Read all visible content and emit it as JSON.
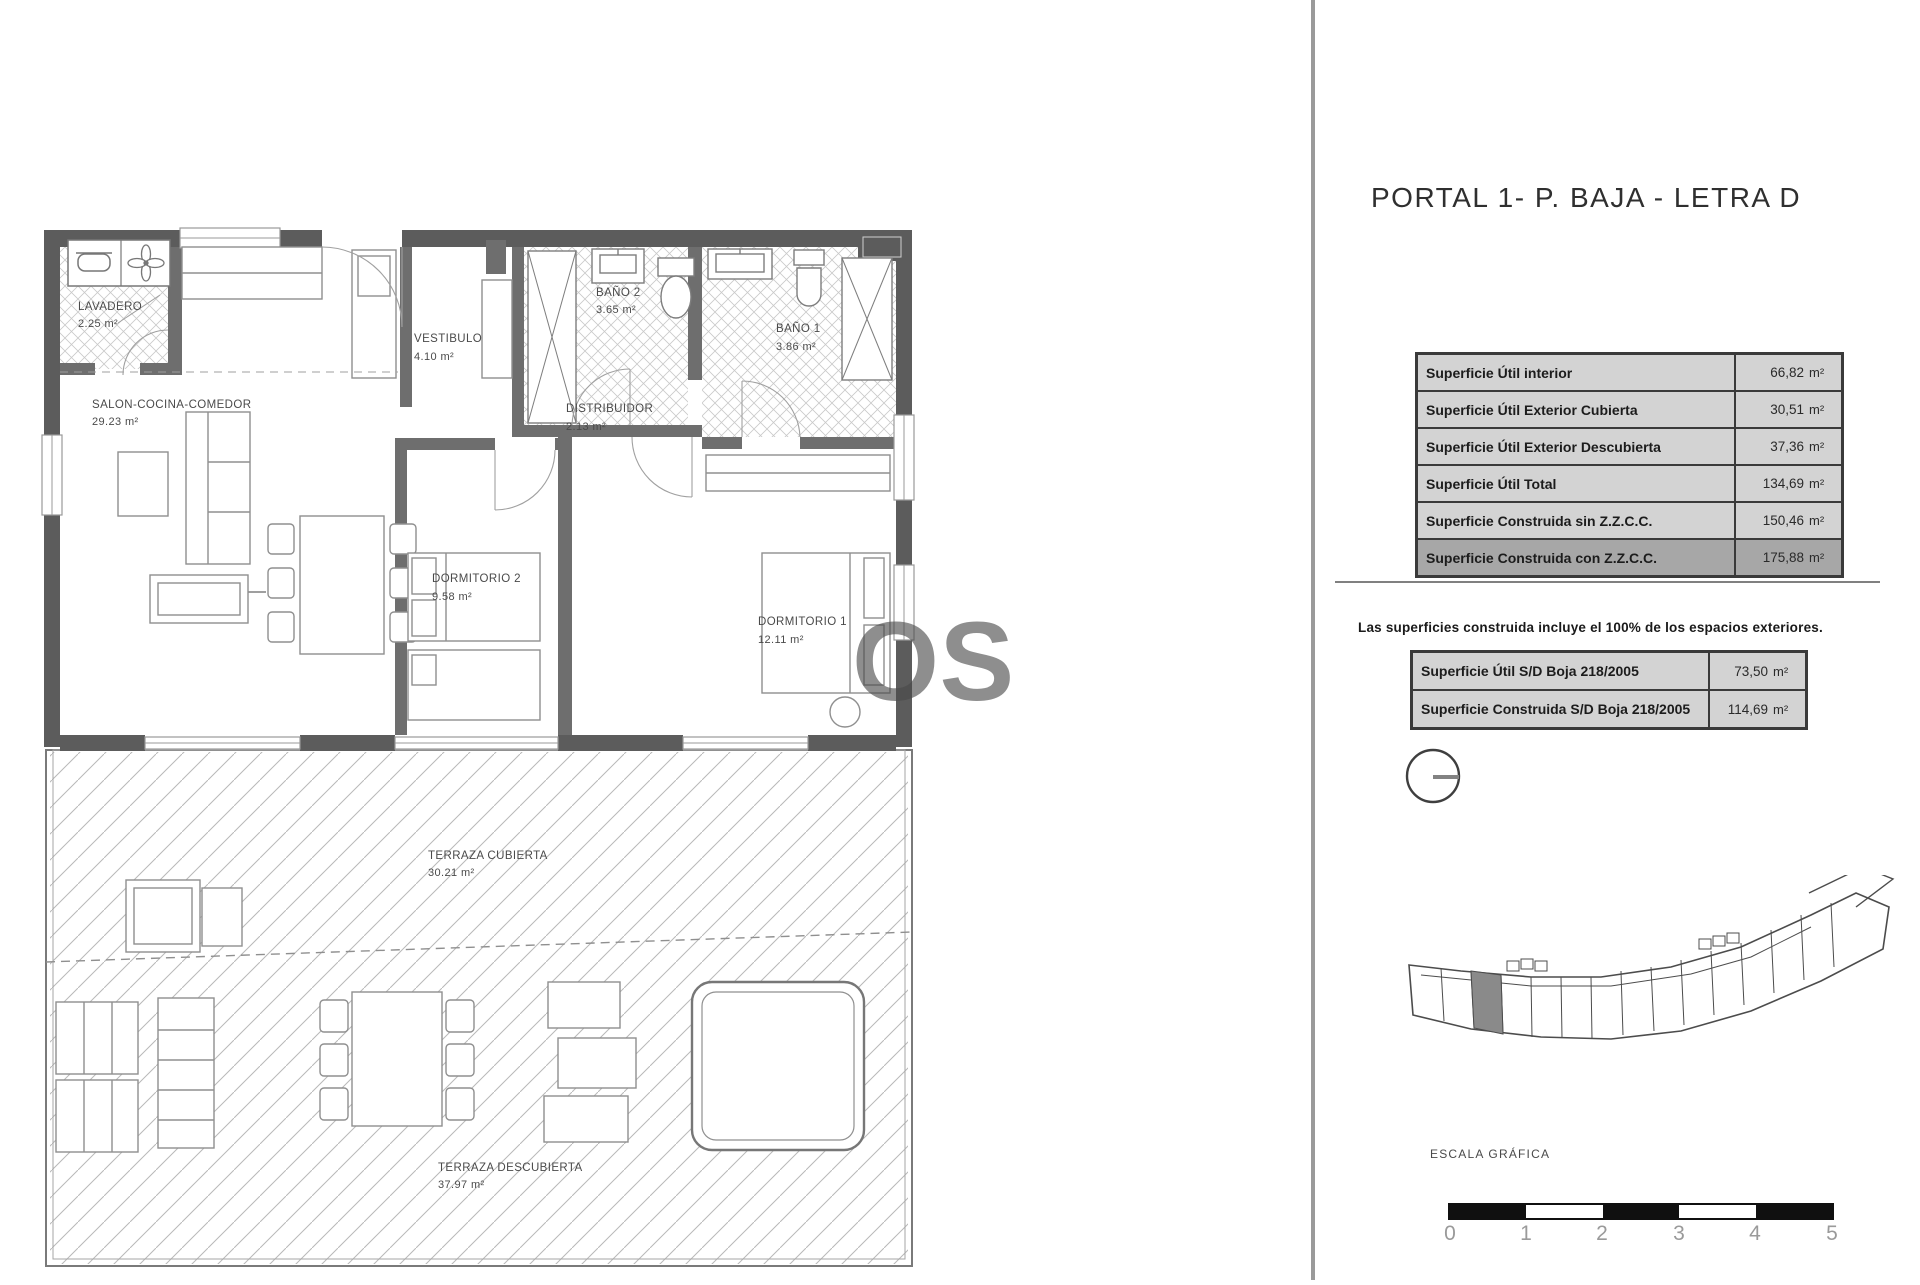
{
  "right_panel": {
    "title": "PORTAL 1- P. BAJA - LETRA D",
    "surface_table": {
      "rows": [
        {
          "label": "Superficie Útil interior",
          "value": "66,82",
          "unit": "m²"
        },
        {
          "label": "Superficie Útil Exterior Cubierta",
          "value": "30,51",
          "unit": "m²"
        },
        {
          "label": "Superficie Útil Exterior Descubierta",
          "value": "37,36",
          "unit": "m²"
        },
        {
          "label": "Superficie Útil Total",
          "value": "134,69",
          "unit": "m²"
        },
        {
          "label": "Superficie Construida sin Z.Z.C.C.",
          "value": "150,46",
          "unit": "m²"
        },
        {
          "label": "Superficie Construida con Z.Z.C.C.",
          "value": "175,88",
          "unit": "m²"
        }
      ]
    },
    "note": "Las superficies construida incluye el 100% de los espacios exteriores.",
    "boja_table": {
      "rows": [
        {
          "label": "Superficie Útil S/D Boja 218/2005",
          "value": "73,50",
          "unit": "m²"
        },
        {
          "label": "Superficie Construida S/D Boja 218/2005",
          "value": "114,69",
          "unit": "m²"
        }
      ]
    },
    "scale": {
      "label": "ESCALA GRÁFICA",
      "ticks": [
        "0",
        "1",
        "2",
        "3",
        "4",
        "5"
      ]
    }
  },
  "floor_plan": {
    "watermark": "OS",
    "rooms": [
      {
        "name": "LAVADERO",
        "area": "2.25 m²"
      },
      {
        "name": "VESTIBULO",
        "area": "4.10 m²"
      },
      {
        "name": "BAÑO 2",
        "area": "3.65 m²"
      },
      {
        "name": "BAÑO 1",
        "area": "3.86 m²"
      },
      {
        "name": "SALON-COCINA-COMEDOR",
        "area": "29.23 m²"
      },
      {
        "name": "DISTRIBUIDOR",
        "area": "2.13 m²"
      },
      {
        "name": "DORMITORIO 2",
        "area": "9.58 m²"
      },
      {
        "name": "DORMITORIO 1",
        "area": "12.11 m²"
      },
      {
        "name": "TERRAZA CUBIERTA",
        "area": "30.21 m²"
      },
      {
        "name": "TERRAZA DESCUBIERTA",
        "area": "37.97 m²"
      }
    ]
  },
  "colors": {
    "wall_dark": "#5c5c5c",
    "wall_mid": "#6e6e6e",
    "table_row": "#d3d3d3",
    "table_row_dark": "#a7a7a7",
    "divider": "#9a9a9a",
    "scale_black": "#101010"
  }
}
